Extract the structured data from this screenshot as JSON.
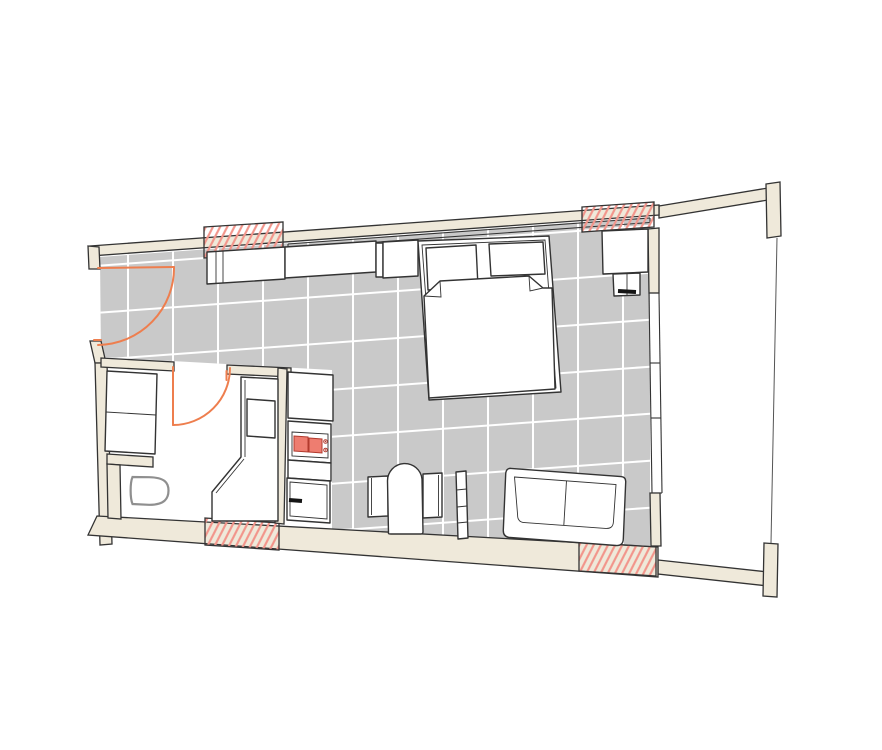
{
  "title": "studio-apartment-floor-plan",
  "colors": {
    "background": "#ffffff",
    "wall": "#efe9da",
    "line": "#333333",
    "floor": "#c9c9c9",
    "grid": "#ffffff",
    "hatch": "#f2958b",
    "accent_door": "#ee7e4e",
    "burner": "#ee7d70",
    "burner_line": "#b23a2e",
    "fixture": "#8f8f8f"
  },
  "elements": {
    "rooms": [
      "main-room",
      "bathroom",
      "balcony"
    ],
    "architecture": [
      "exterior-walls",
      "north-window-band",
      "east-window-wall",
      "hatched-wall-opening-top-left",
      "hatched-wall-opening-top-right",
      "hatched-wall-opening-bottom-left",
      "hatched-wall-opening-bottom-right",
      "balcony-partition-wall-top",
      "balcony-partition-wall-bottom",
      "balcony-railing",
      "floor-tile-grid"
    ],
    "furniture": [
      "entrance-door-swing",
      "bathroom-door-swing",
      "shower-washer-unit",
      "toilet",
      "vanity-counter",
      "vanity-sink",
      "kitchen-cabinet",
      "stove-two-burners",
      "stove-knobs",
      "oven",
      "wardrobe-left",
      "wardrobe-center",
      "wardrobe-right",
      "double-bed",
      "pillow-left",
      "pillow-right",
      "duvet",
      "nightstand",
      "side-stool",
      "desk-left-leaf",
      "desk-right-leaf",
      "chair",
      "radiator",
      "two-seat-sofa"
    ]
  }
}
